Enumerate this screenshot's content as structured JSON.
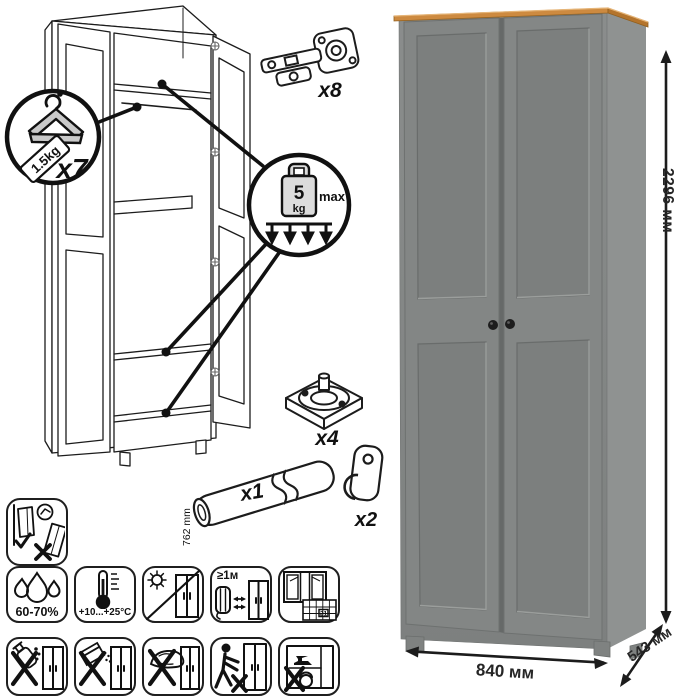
{
  "product": {
    "kind": "two-door wardrobe assembly diagram"
  },
  "parts": {
    "hanger": {
      "qty": "x7",
      "tag": "1.5kg"
    },
    "hinge": {
      "qty": "x8"
    },
    "shelf_load": {
      "value": "5",
      "unit": "kg",
      "max_label": "max"
    },
    "foot": {
      "qty": "x4"
    },
    "rod": {
      "qty": "x1",
      "length": "762 mm"
    },
    "hook": {
      "qty": "x2"
    }
  },
  "dimensions": {
    "height": "2296 мм",
    "width": "840 мм",
    "depth": "543 мм"
  },
  "care": {
    "humidity": "60-70%",
    "temperature": "+10...+25°C",
    "heat_distance": "≥1м",
    "acclimatization_days": "21"
  },
  "colors": {
    "line": "#1c1c1c",
    "wood_top": "#cd8a40",
    "cabinet_front": "#828584",
    "cabinet_side": "#8f9291",
    "panel_recess": "#7c7f7e",
    "knob": "#1d1d1d"
  }
}
